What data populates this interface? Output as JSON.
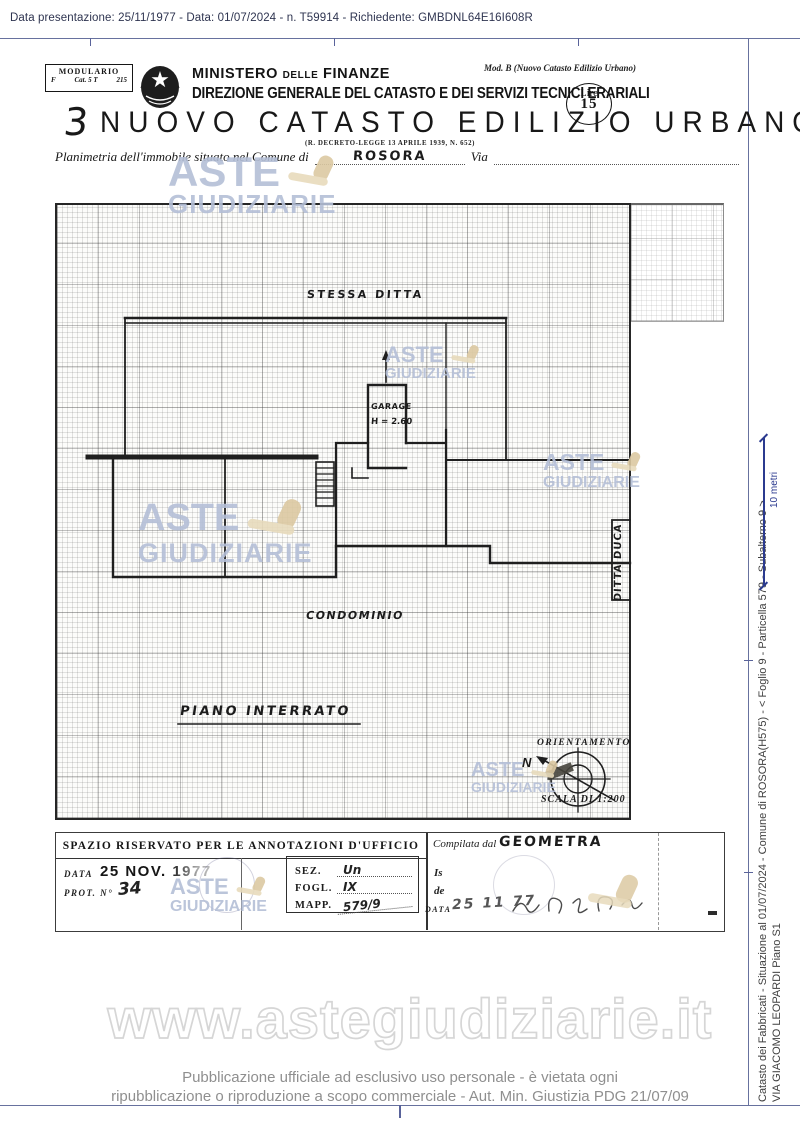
{
  "viewer": {
    "header_text": "Data presentazione: 25/11/1977 - Data: 01/07/2024 - n. T59914 - Richiedente: GMBDNL64E16I608R",
    "url_watermark": "www.astegiudiziarie.it",
    "footer_line1": "Pubblicazione ufficiale ad esclusivo uso personale - è vietata ogni",
    "footer_line2": "ripubblicazione o riproduzione a scopo commerciale - Aut. Min. Giustizia PDG 21/07/09",
    "margin_note_line1": "Catasto dei Fabbricati - Situazione al 01/07/2024 - Comune di ROSORA(H575) - <  Foglio 9 - Particella  579 - Subalterno 9 >",
    "margin_note_line2": "VIA GIACOMO LEOPARDI Piano S1",
    "scale_bar_label": "10 metri"
  },
  "watermark": {
    "line1": "ASTE",
    "line2": "GIUDIZIARIE"
  },
  "doc": {
    "modulario_title": "MODULARIO",
    "modulario_col1": "F",
    "modulario_col2": "Cat. 5 T",
    "modulario_col3": "215",
    "ministry": "MINISTERO delle FINANZE",
    "direction": "DIREZIONE GENERALE DEL CATASTO E DEI SERVIZI TECNICI ERARIALI",
    "mod_b": "Mod. B (Nuovo Catasto Edilizio Urbano)",
    "lire_label": "Lire",
    "lire_value": "15",
    "form_number": "3",
    "title": "NUOVO CATASTO EDILIZIO URBANO",
    "law_ref": "(R. DECRETO-LEGGE 13 APRILE 1939, N. 652)",
    "planimetria_prefix": "Planimetria dell'immobile situato nel Comune di",
    "comune_value": "ROSORA",
    "via_label": "Via"
  },
  "plan": {
    "stessa_ditta": "STESSA DITTA",
    "garage": "GARAGE",
    "garage_height": "H = 2.60",
    "condominio": "CONDOMINIO",
    "piano_interrato": "PIANO INTERRATO",
    "ditta_duca": "DITTA DUCA",
    "orientamento": "ORIENTAMENTO",
    "north": "N",
    "scala": "SCALA DI 1:200"
  },
  "form": {
    "header": "SPAZIO RISERVATO PER LE ANNOTAZIONI D'UFFICIO",
    "data_label": "DATA",
    "date_stamp": "25 NOV. 1977",
    "prot_label": "PROT. N°",
    "prot_value": "34",
    "sez_label": "SEZ.",
    "sez_value": "Un",
    "fogl_label": "FOGL.",
    "fogl_value": "IX",
    "mapp_label": "MAPP.",
    "mapp_value": "579/9",
    "compilata_label": "Compilata dal",
    "compilata_value": "GEOMETRA",
    "is_label": "Is",
    "de_label": "de",
    "date2_label": "DATA",
    "date2_value": "25 11 77"
  }
}
